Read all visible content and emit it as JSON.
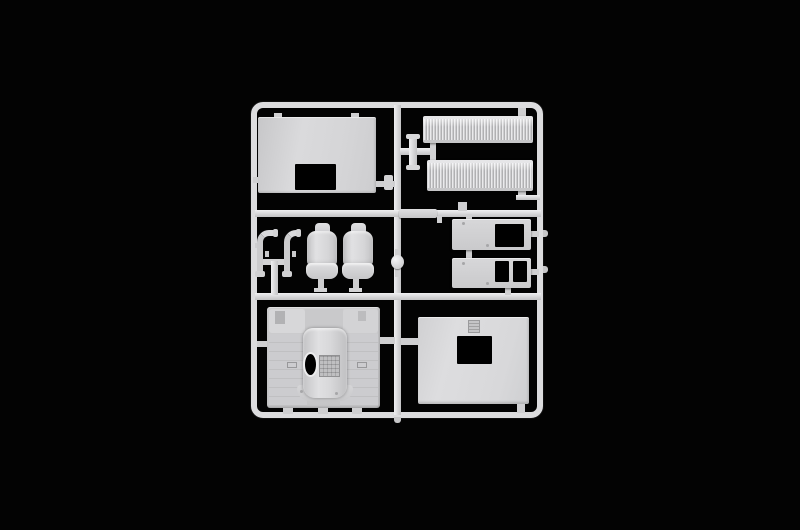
{
  "scene": {
    "type": "photograph",
    "description": "Injection-molded plastic model kit sprue (runner) holding light-gray truck-cab parts, photographed on a black background",
    "background_color": "#030303",
    "colors": {
      "bg": "#030303",
      "runner": "#dcdcde",
      "runner-hi": "#f0f0f2",
      "runner-lo": "#c2c2c4",
      "plastic": "#d4d4d6",
      "plastic-hi": "#e4e4e6",
      "plastic-lo": "#bfbfc1",
      "opening": "#000000",
      "gate": "#cfcfd1"
    }
  },
  "sprue": {
    "frame": {
      "label": "Rectangular sprue frame with rounded corners, center runner and two cross runners"
    },
    "parts": [
      {
        "id": "cab-rear-panel",
        "label": "Cab rear panel with rectangular window opening and two top tabs"
      },
      {
        "id": "grille-upper",
        "label": "Ribbed grille / step panel (upper)"
      },
      {
        "id": "grille-lower",
        "label": "Ribbed grille / step panel (lower)"
      },
      {
        "id": "grab-handle-left",
        "label": "Tubular grab handle (left)"
      },
      {
        "id": "grab-handle-right",
        "label": "Tubular grab handle (right)"
      },
      {
        "id": "seat-left",
        "label": "Cab seat with headrest (left)"
      },
      {
        "id": "seat-right",
        "label": "Cab seat with headrest (right)"
      },
      {
        "id": "door-card-upper",
        "label": "Interior panel with one rectangular cutout"
      },
      {
        "id": "door-card-lower",
        "label": "Interior panel with two rectangular cutouts"
      },
      {
        "id": "trim-strip",
        "label": "Thin flat trim strip on runner"
      },
      {
        "id": "sprue-knob",
        "label": "Small round molding knob on center runner"
      },
      {
        "id": "cab-floor",
        "label": "Cab floor with engine tunnel, oval steering hole and textured pedal plate"
      },
      {
        "id": "cab-front-panel",
        "label": "Cab panel with rectangular cutout and small hatch detail"
      }
    ]
  }
}
